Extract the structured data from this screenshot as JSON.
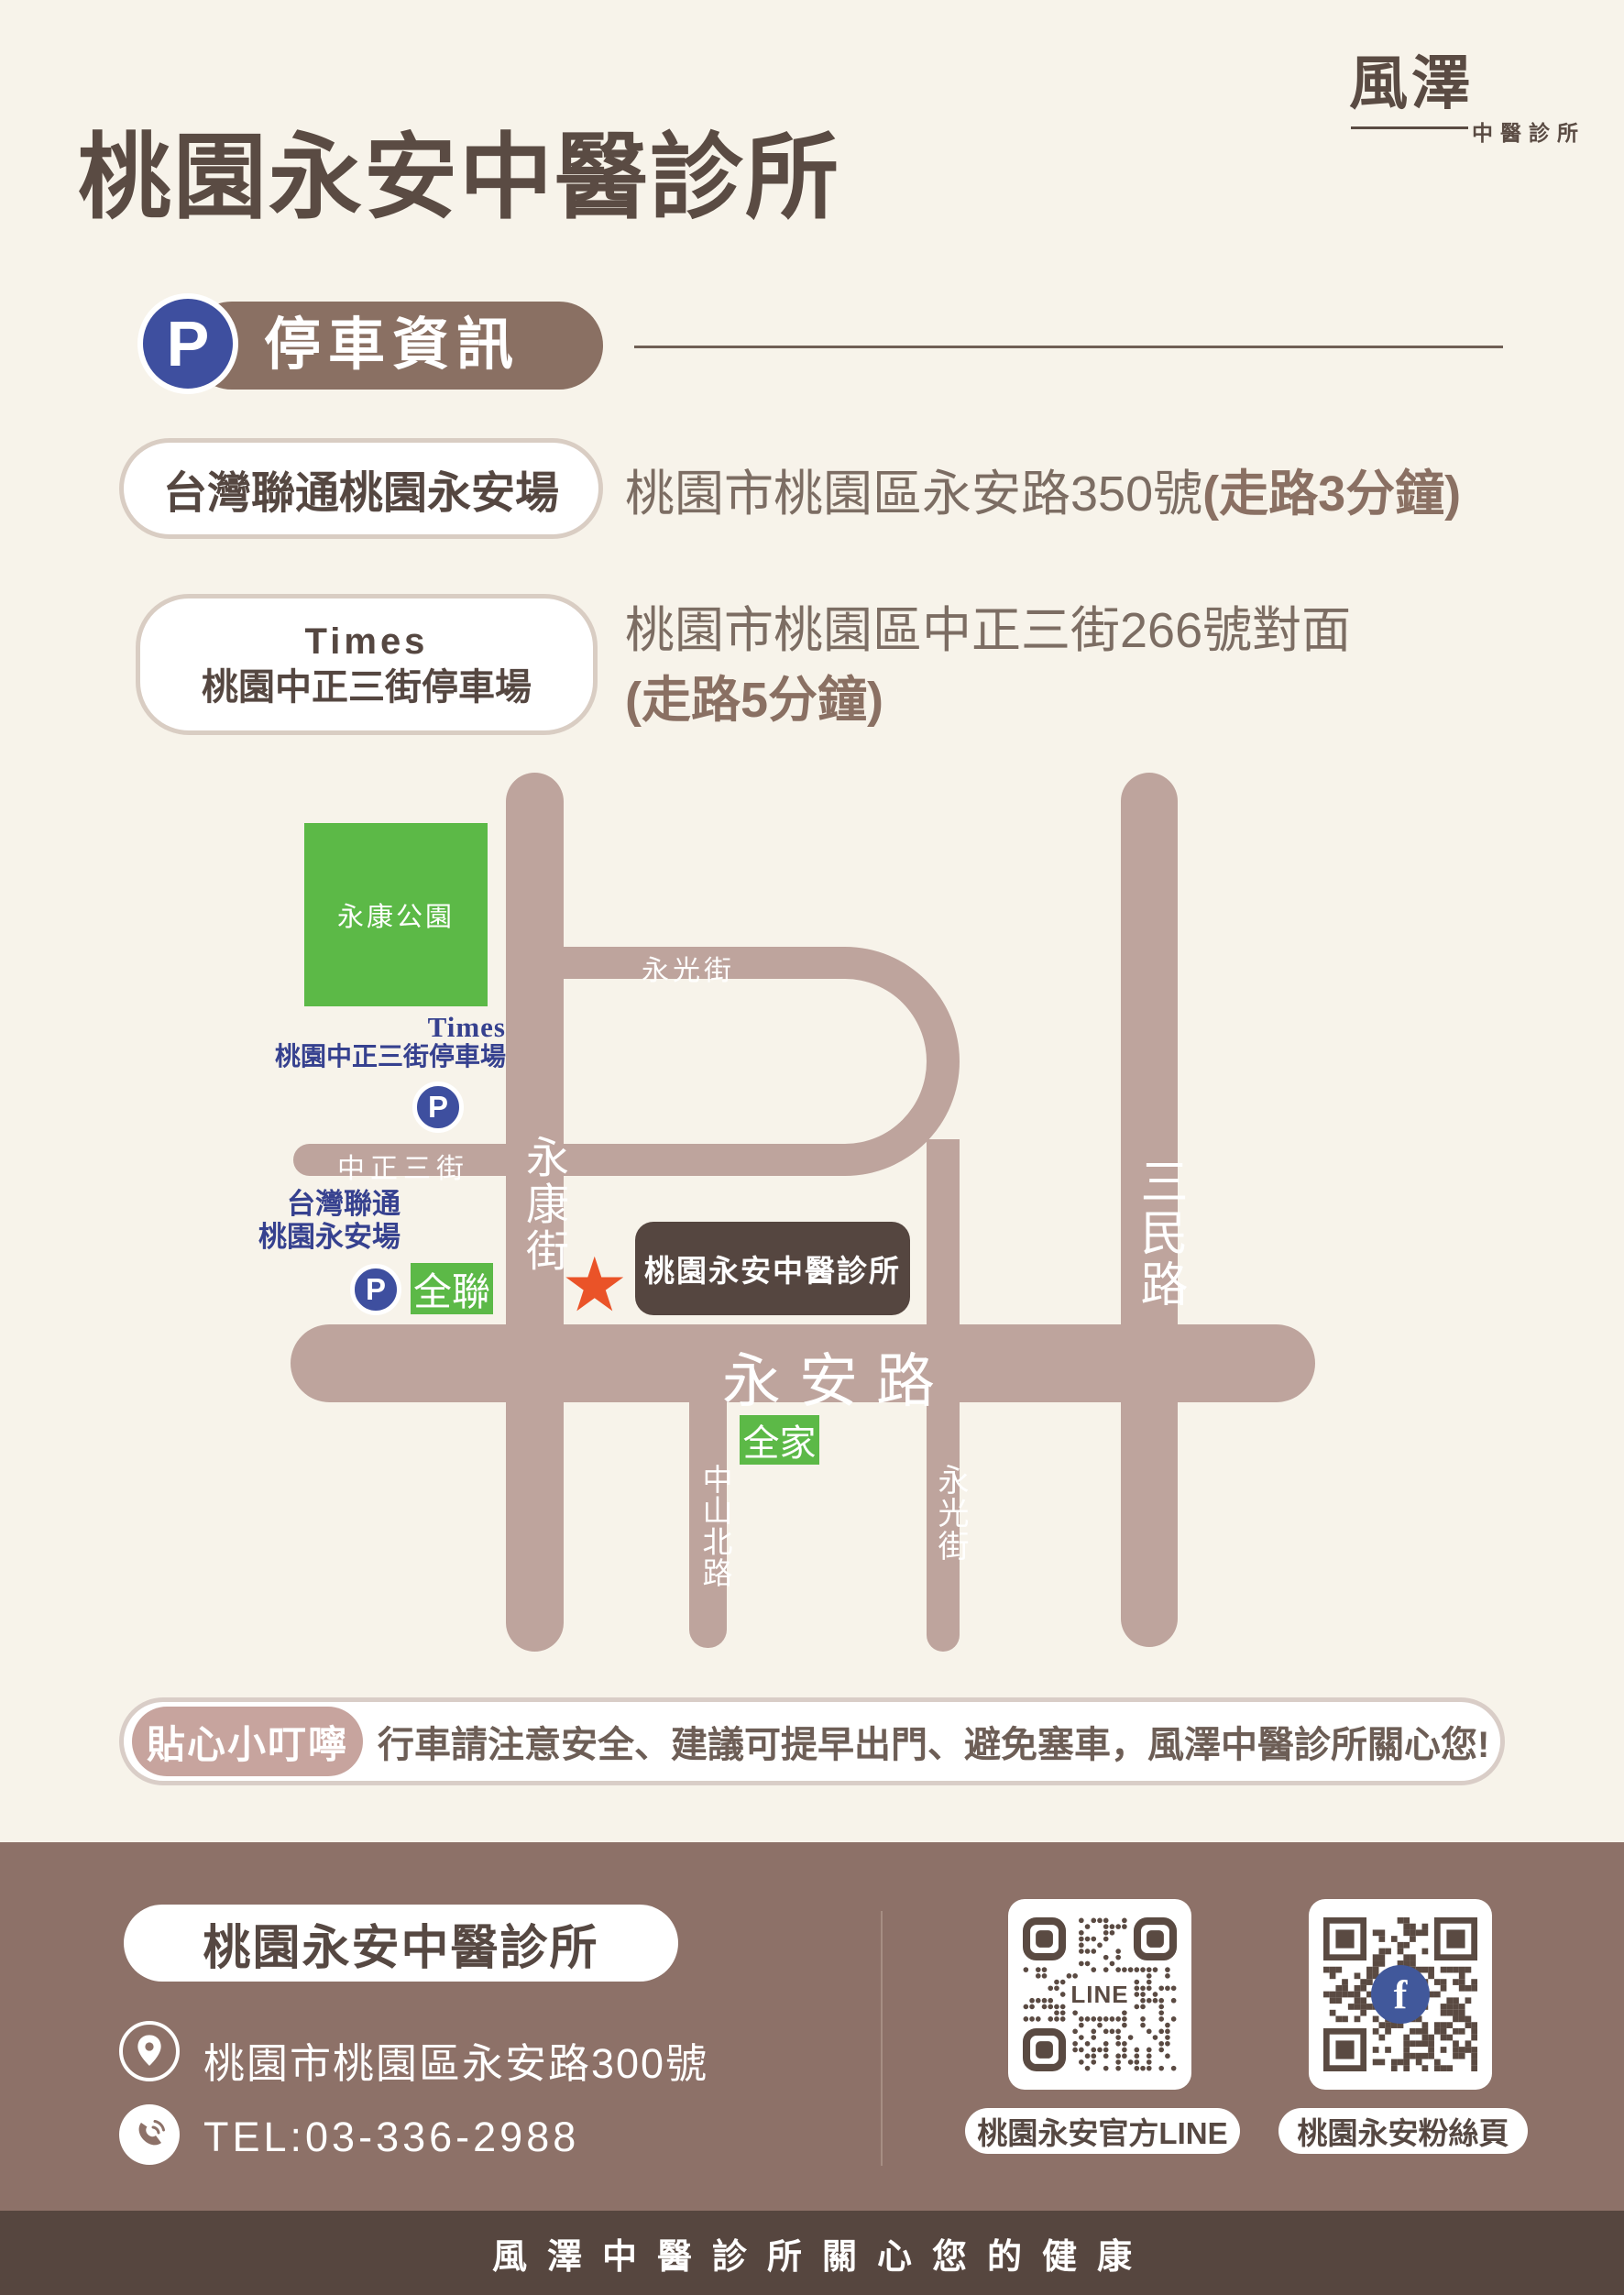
{
  "title": "桃園永安中醫診所",
  "logo": {
    "script": "風澤",
    "subtitle": "中醫診所"
  },
  "section_header": {
    "p": "P",
    "label": "停車資訊"
  },
  "parking": {
    "items": [
      {
        "name": "台灣聯通桃園永安場",
        "address": "桃園市桃園區永安路350號 ",
        "walk": "(走路3分鐘)"
      },
      {
        "name": "Times",
        "name_line2": "桃園中正三街停車場",
        "address": "桃園市桃園區中正三街266號對面",
        "walk": "(走路5分鐘)"
      }
    ]
  },
  "map": {
    "park": "永康公園",
    "roads": {
      "yongkang": "永康街",
      "yongguang_n": "永光街",
      "zhongzheng3": "中正三街",
      "yongan": "永安路",
      "zhongshan_n": "中山北路",
      "yongguang_s": "永光街",
      "sanmin": "三民路"
    },
    "times_label": {
      "line1": "Times",
      "line2": "桃園中正三街停車場"
    },
    "taiwan_label": {
      "line1": "台灣聯通",
      "line2": "桃園永安場"
    },
    "p_icon": "P",
    "pxmart_badge": "全聯",
    "familymart_badge": "全家",
    "star": "★",
    "clinic": "桃園永安中醫診所"
  },
  "notice": {
    "badge": "貼心小叮嚀",
    "text": "行車請注意安全、建議可提早出門、避免塞車，風澤中醫診所關心您!"
  },
  "footer": {
    "clinic": "桃園永安中醫診所",
    "address": "桃園市桃園區永安路300號",
    "tel": "TEL:03-336-2988",
    "qr_line": {
      "center": "LINE",
      "label": "桃園永安官方LINE"
    },
    "qr_fb": {
      "center": "f",
      "label": "桃園永安粉絲頁"
    },
    "tagline": "風澤中醫診所關心您的健康"
  },
  "colors": {
    "background": "#f7f3ea",
    "title_brown": "#5a4b43",
    "header_pill": "#8a7063",
    "p_badge_blue": "#3e4f9f",
    "road_mauve": "#bea49d",
    "park_green": "#5cb947",
    "map_label_navy": "#36418f",
    "clinic_box": "#554640",
    "star_orange": "#ea5328",
    "notice_pill": "#c7a49e",
    "footer_brown": "#8d7168",
    "footer_strip": "#56463f",
    "fb_blue": "#41589b"
  }
}
